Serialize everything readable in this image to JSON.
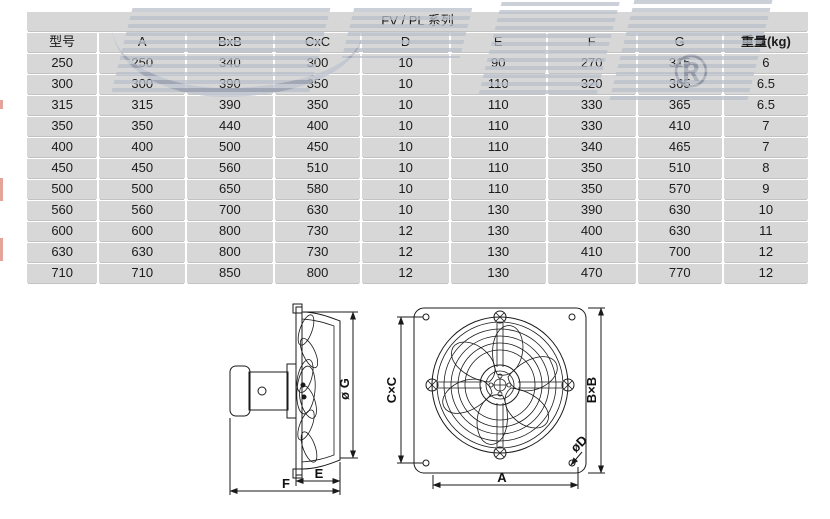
{
  "table": {
    "title": "FV / PL 系列",
    "columns": [
      "型号",
      "A",
      "BxB",
      "CxC",
      "D",
      "E",
      "F",
      "G",
      "重量(kg)"
    ],
    "rows": [
      [
        "250",
        "250",
        "340",
        "300",
        "10",
        "90",
        "270",
        "315",
        "6"
      ],
      [
        "300",
        "300",
        "390",
        "350",
        "10",
        "110",
        "320",
        "365",
        "6.5"
      ],
      [
        "315",
        "315",
        "390",
        "350",
        "10",
        "110",
        "330",
        "365",
        "6.5"
      ],
      [
        "350",
        "350",
        "440",
        "400",
        "10",
        "110",
        "330",
        "410",
        "7"
      ],
      [
        "400",
        "400",
        "500",
        "450",
        "10",
        "110",
        "340",
        "465",
        "7"
      ],
      [
        "450",
        "450",
        "560",
        "510",
        "10",
        "110",
        "350",
        "510",
        "8"
      ],
      [
        "500",
        "500",
        "650",
        "580",
        "10",
        "110",
        "350",
        "570",
        "9"
      ],
      [
        "560",
        "560",
        "700",
        "630",
        "10",
        "130",
        "390",
        "630",
        "10"
      ],
      [
        "600",
        "600",
        "800",
        "730",
        "12",
        "130",
        "400",
        "630",
        "11"
      ],
      [
        "630",
        "630",
        "800",
        "730",
        "12",
        "130",
        "410",
        "700",
        "12"
      ],
      [
        "710",
        "710",
        "850",
        "800",
        "12",
        "130",
        "470",
        "770",
        "12"
      ]
    ]
  },
  "diagram": {
    "side_view": {
      "labels": {
        "g": "ø G",
        "e": "E",
        "f": "F"
      }
    },
    "front_view": {
      "labels": {
        "cxc": "C×C",
        "bxb": "B×B",
        "a": "A",
        "d": "øD"
      }
    }
  },
  "watermark": {
    "registered": "®"
  },
  "colors": {
    "cell_fill": "#d7d7d7",
    "text": "#1b1b1b",
    "line": "#1a1a1a",
    "watermark_gray": "#b9bfca",
    "watermark_red": "#eaa18f"
  }
}
